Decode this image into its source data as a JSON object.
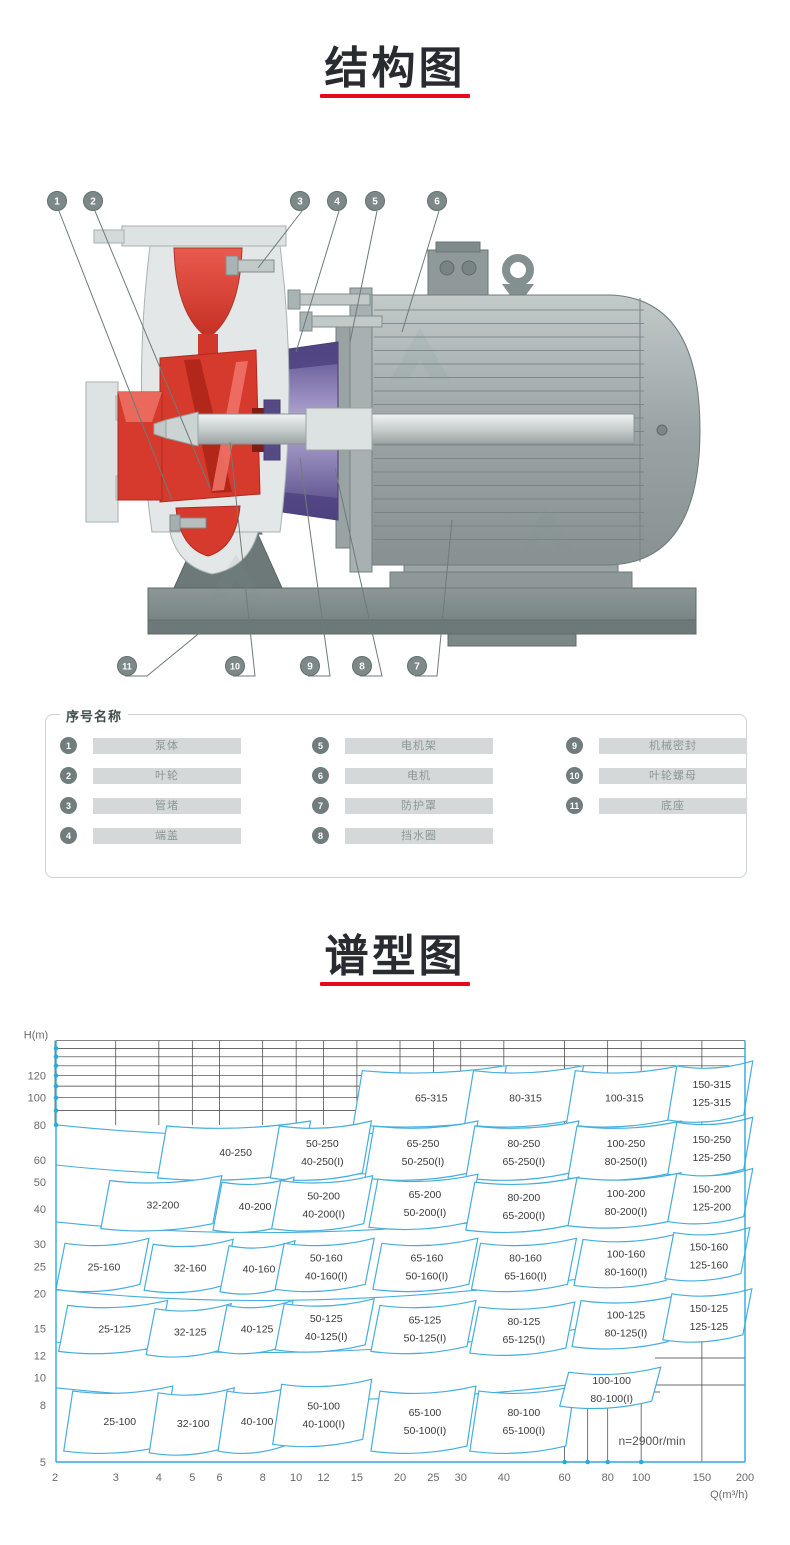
{
  "page": {
    "background": "#ffffff",
    "accent_red": "#e60a1e",
    "title_color": "#2a2a31"
  },
  "sections": {
    "structure": {
      "title": "结构图"
    },
    "spectrum": {
      "title": "谱型图"
    }
  },
  "legend": {
    "title": "序号名称",
    "items": [
      {
        "no": "1",
        "name": "泵体"
      },
      {
        "no": "2",
        "name": "叶轮"
      },
      {
        "no": "3",
        "name": "管堵"
      },
      {
        "no": "4",
        "name": "端盖"
      },
      {
        "no": "5",
        "name": "电机架"
      },
      {
        "no": "6",
        "name": "电机"
      },
      {
        "no": "7",
        "name": "防护罩"
      },
      {
        "no": "8",
        "name": "挡水圈"
      },
      {
        "no": "9",
        "name": "机械密封"
      },
      {
        "no": "10",
        "name": "叶轮螺母"
      },
      {
        "no": "11",
        "name": "底座"
      }
    ]
  },
  "diagram": {
    "callouts": [
      "1",
      "2",
      "3",
      "4",
      "5",
      "6",
      "7",
      "8",
      "9",
      "10",
      "11"
    ],
    "colors": {
      "red": "#d53a2c",
      "purple": "#564a84",
      "gray": "#9aa4a4"
    }
  },
  "chart_data": {
    "type": "area",
    "title": "谱型图",
    "xlabel": "Q(m³/h)",
    "ylabel": "H(m)",
    "x_scale": "log",
    "y_scale": "log",
    "x_range": [
      2,
      200
    ],
    "y_range": [
      5,
      160
    ],
    "x_ticks": [
      2,
      3,
      4,
      5,
      6,
      8,
      10,
      12,
      15,
      20,
      25,
      30,
      40,
      60,
      80,
      100,
      150,
      200
    ],
    "y_ticks": [
      120,
      100,
      80,
      60,
      50,
      40,
      30,
      25,
      20,
      15,
      12,
      10,
      8,
      5
    ],
    "grid_top_h_lines": [
      160,
      150,
      140,
      130,
      120,
      110,
      100,
      90
    ],
    "axis_marker_q": [
      60,
      70,
      80,
      100
    ],
    "speed_note": "n=2900r/min",
    "line_color": "#45aede",
    "axis_color": "#29abe2",
    "grid_color": "#3a3a3a",
    "regions": [
      {
        "labels": [
          "65-315"
        ],
        "q": 24,
        "h": 100,
        "w": 72,
        "hh": 27
      },
      {
        "labels": [
          "80-315"
        ],
        "q": 45,
        "h": 100,
        "w": 55,
        "hh": 27
      },
      {
        "labels": [
          "100-315"
        ],
        "q": 87,
        "h": 100,
        "w": 52,
        "hh": 27
      },
      {
        "labels": [
          "150-315",
          "125-315"
        ],
        "q": 156,
        "h": 104,
        "w": 38,
        "hh": 27
      },
      {
        "labels": [
          "40-250"
        ],
        "q": 6.5,
        "h": 64,
        "w": 72,
        "hh": 26
      },
      {
        "labels": [
          "50-250",
          "40-250(I)"
        ],
        "q": 11.6,
        "h": 64,
        "w": 46,
        "hh": 26
      },
      {
        "labels": [
          "65-250",
          "50-250(I)"
        ],
        "q": 22.7,
        "h": 64,
        "w": 52,
        "hh": 26
      },
      {
        "labels": [
          "80-250",
          "65-250(I)"
        ],
        "q": 44.5,
        "h": 64,
        "w": 52,
        "hh": 26
      },
      {
        "labels": [
          "100-250",
          "80-250(I)"
        ],
        "q": 88,
        "h": 64,
        "w": 52,
        "hh": 26
      },
      {
        "labels": [
          "150-250",
          "125-250"
        ],
        "q": 156,
        "h": 66,
        "w": 38,
        "hh": 26
      },
      {
        "labels": [
          "32-200"
        ],
        "q": 4.0,
        "h": 41.5,
        "w": 56,
        "hh": 24
      },
      {
        "labels": [
          "40-200"
        ],
        "q": 7.4,
        "h": 41,
        "w": 36,
        "hh": 24
      },
      {
        "labels": [
          "50-200",
          "40-200(I)"
        ],
        "q": 11.7,
        "h": 41.5,
        "w": 46,
        "hh": 24
      },
      {
        "labels": [
          "65-200",
          "50-200(I)"
        ],
        "q": 23,
        "h": 42,
        "w": 50,
        "hh": 24
      },
      {
        "labels": [
          "80-200",
          "65-200(I)"
        ],
        "q": 44.5,
        "h": 41,
        "w": 52,
        "hh": 24
      },
      {
        "labels": [
          "100-200",
          "80-200(I)"
        ],
        "q": 88,
        "h": 42.5,
        "w": 52,
        "hh": 24
      },
      {
        "labels": [
          "150-200",
          "125-200"
        ],
        "q": 156,
        "h": 44,
        "w": 38,
        "hh": 24
      },
      {
        "labels": [
          "25-160"
        ],
        "q": 2.7,
        "h": 25,
        "w": 42,
        "hh": 23
      },
      {
        "labels": [
          "32-160"
        ],
        "q": 4.8,
        "h": 24.8,
        "w": 40,
        "hh": 23
      },
      {
        "labels": [
          "40-160"
        ],
        "q": 7.6,
        "h": 24.5,
        "w": 33,
        "hh": 23
      },
      {
        "labels": [
          "50-160",
          "40-160(I)"
        ],
        "q": 11.9,
        "h": 25,
        "w": 45,
        "hh": 23
      },
      {
        "labels": [
          "65-160",
          "50-160(I)"
        ],
        "q": 23.3,
        "h": 25,
        "w": 48,
        "hh": 23
      },
      {
        "labels": [
          "80-160",
          "65-160(I)"
        ],
        "q": 45,
        "h": 25,
        "w": 48,
        "hh": 23
      },
      {
        "labels": [
          "100-160",
          "80-160(I)"
        ],
        "q": 88,
        "h": 25.8,
        "w": 46,
        "hh": 23
      },
      {
        "labels": [
          "150-160",
          "125-160"
        ],
        "q": 153,
        "h": 27.3,
        "w": 38,
        "hh": 23
      },
      {
        "labels": [
          "25-125"
        ],
        "q": 2.9,
        "h": 15,
        "w": 50,
        "hh": 23
      },
      {
        "labels": [
          "32-125"
        ],
        "q": 4.8,
        "h": 14.6,
        "w": 38,
        "hh": 23
      },
      {
        "labels": [
          "40-125"
        ],
        "q": 7.5,
        "h": 15,
        "w": 33,
        "hh": 23
      },
      {
        "labels": [
          "50-125",
          "40-125(I)"
        ],
        "q": 11.9,
        "h": 15.2,
        "w": 45,
        "hh": 23
      },
      {
        "labels": [
          "65-125",
          "50-125(I)"
        ],
        "q": 23,
        "h": 15,
        "w": 48,
        "hh": 23
      },
      {
        "labels": [
          "80-125",
          "65-125(I)"
        ],
        "q": 44.5,
        "h": 14.8,
        "w": 48,
        "hh": 23
      },
      {
        "labels": [
          "100-125",
          "80-125(I)"
        ],
        "q": 88,
        "h": 15.6,
        "w": 48,
        "hh": 23
      },
      {
        "labels": [
          "150-125",
          "125-125"
        ],
        "q": 153,
        "h": 16.5,
        "w": 40,
        "hh": 23
      },
      {
        "labels": [
          "25-100"
        ],
        "q": 3.0,
        "h": 7.0,
        "w": 50,
        "hh": 30
      },
      {
        "labels": [
          "32-100"
        ],
        "q": 4.9,
        "h": 6.9,
        "w": 38,
        "hh": 30
      },
      {
        "labels": [
          "40-100"
        ],
        "q": 7.5,
        "h": 7.0,
        "w": 33,
        "hh": 30
      },
      {
        "labels": [
          "50-100",
          "40-100(I)"
        ],
        "q": 11.7,
        "h": 7.4,
        "w": 45,
        "hh": 30
      },
      {
        "labels": [
          "65-100",
          "50-100(I)"
        ],
        "q": 23,
        "h": 7.0,
        "w": 48,
        "hh": 30
      },
      {
        "labels": [
          "80-100",
          "65-100(I)"
        ],
        "q": 44.5,
        "h": 7.0,
        "w": 48,
        "hh": 30
      },
      {
        "labels": [
          "100-100",
          "80-100(I)"
        ],
        "q": 80,
        "h": 9.1,
        "w": 46,
        "hh": 17
      }
    ]
  }
}
